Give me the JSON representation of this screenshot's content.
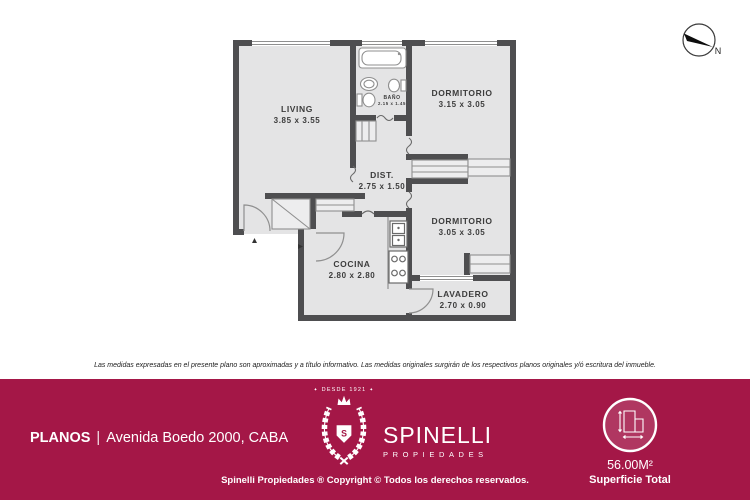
{
  "colors": {
    "accent": "#a41747",
    "wall": "#4e4e50",
    "room_fill": "#e4e4e5",
    "fixture_stroke": "#8f8f8f",
    "label_text": "#3c3c3c"
  },
  "compass": {
    "north_label": "N"
  },
  "floorplan": {
    "rooms": [
      {
        "id": "living",
        "name": "LIVING",
        "dims": "3.85 x 3.55"
      },
      {
        "id": "bano",
        "name": "BAÑO",
        "dims": "2.15 x 1.45"
      },
      {
        "id": "dormitorio1",
        "name": "DORMITORIO",
        "dims": "3.15 x 3.05"
      },
      {
        "id": "dist",
        "name": "DIST.",
        "dims": "2.75 x 1.50"
      },
      {
        "id": "dormitorio2",
        "name": "DORMITORIO",
        "dims": "3.05 x 3.05"
      },
      {
        "id": "cocina",
        "name": "COCINA",
        "dims": "2.80 x 2.80"
      },
      {
        "id": "lavadero",
        "name": "LAVADERO",
        "dims": "2.70 x 0.90"
      }
    ]
  },
  "disclaimer": "Las medidas expresadas en el presente plano son aproximadas y a título informativo. Las medidas originales surgirán de los respectivos planos originales y/ó escritura del inmueble.",
  "footer": {
    "section_label": "PLANOS",
    "separator": "|",
    "address": "Avenida Boedo 2000, CABA",
    "brand": {
      "since": "DESDE 1921",
      "decor": "✦",
      "name": "SPINELLI",
      "subtitle": "PROPIEDADES",
      "monogram": "S"
    },
    "copyright": "Spinelli Propiedades ® Copyright © Todos los derechos reservados.",
    "surface": {
      "value": "56.00M²",
      "label": "Superficie Total"
    }
  }
}
